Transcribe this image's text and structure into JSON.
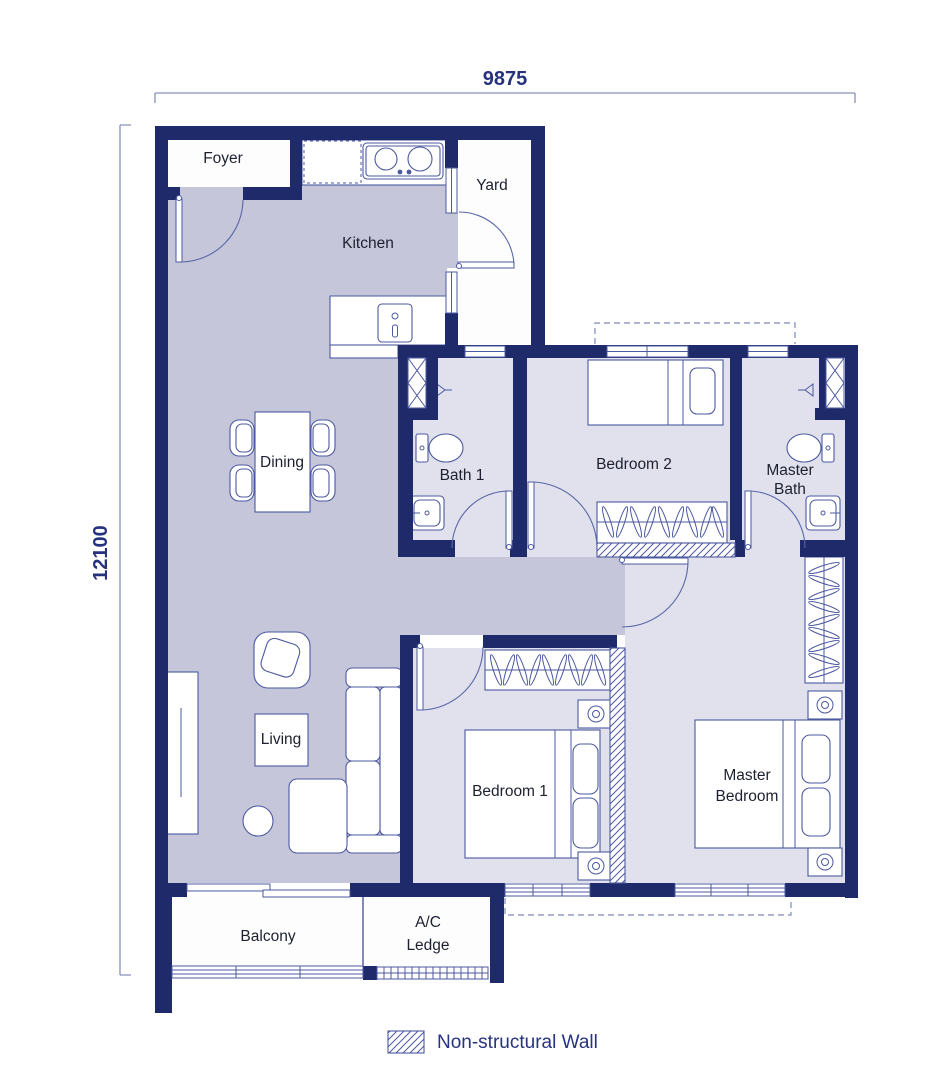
{
  "dimensions": {
    "top": "9875",
    "left": "12100"
  },
  "rooms": {
    "foyer": "Foyer",
    "kitchen": "Kitchen",
    "yard": "Yard",
    "dining": "Dining",
    "bath1": "Bath 1",
    "bedroom2": "Bedroom 2",
    "master_bath_1": "Master",
    "master_bath_2": "Bath",
    "living": "Living",
    "bedroom1": "Bedroom 1",
    "master_bedroom_1": "Master",
    "master_bedroom_2": "Bedroom",
    "balcony": "Balcony",
    "ac_ledge_1": "A/C",
    "ac_ledge_2": "Ledge"
  },
  "legend": {
    "non_structural_wall": "Non-structural Wall"
  },
  "colors": {
    "wall": "#1f2a6b",
    "floor_living_areas": "#c5c6d9",
    "floor_bedrooms": "#e0e1ed",
    "floor_exterior": "#fdfdfe",
    "furniture_line": "#4d59a0",
    "dimension_text": "#26327e",
    "legend_text": "#27337f"
  }
}
